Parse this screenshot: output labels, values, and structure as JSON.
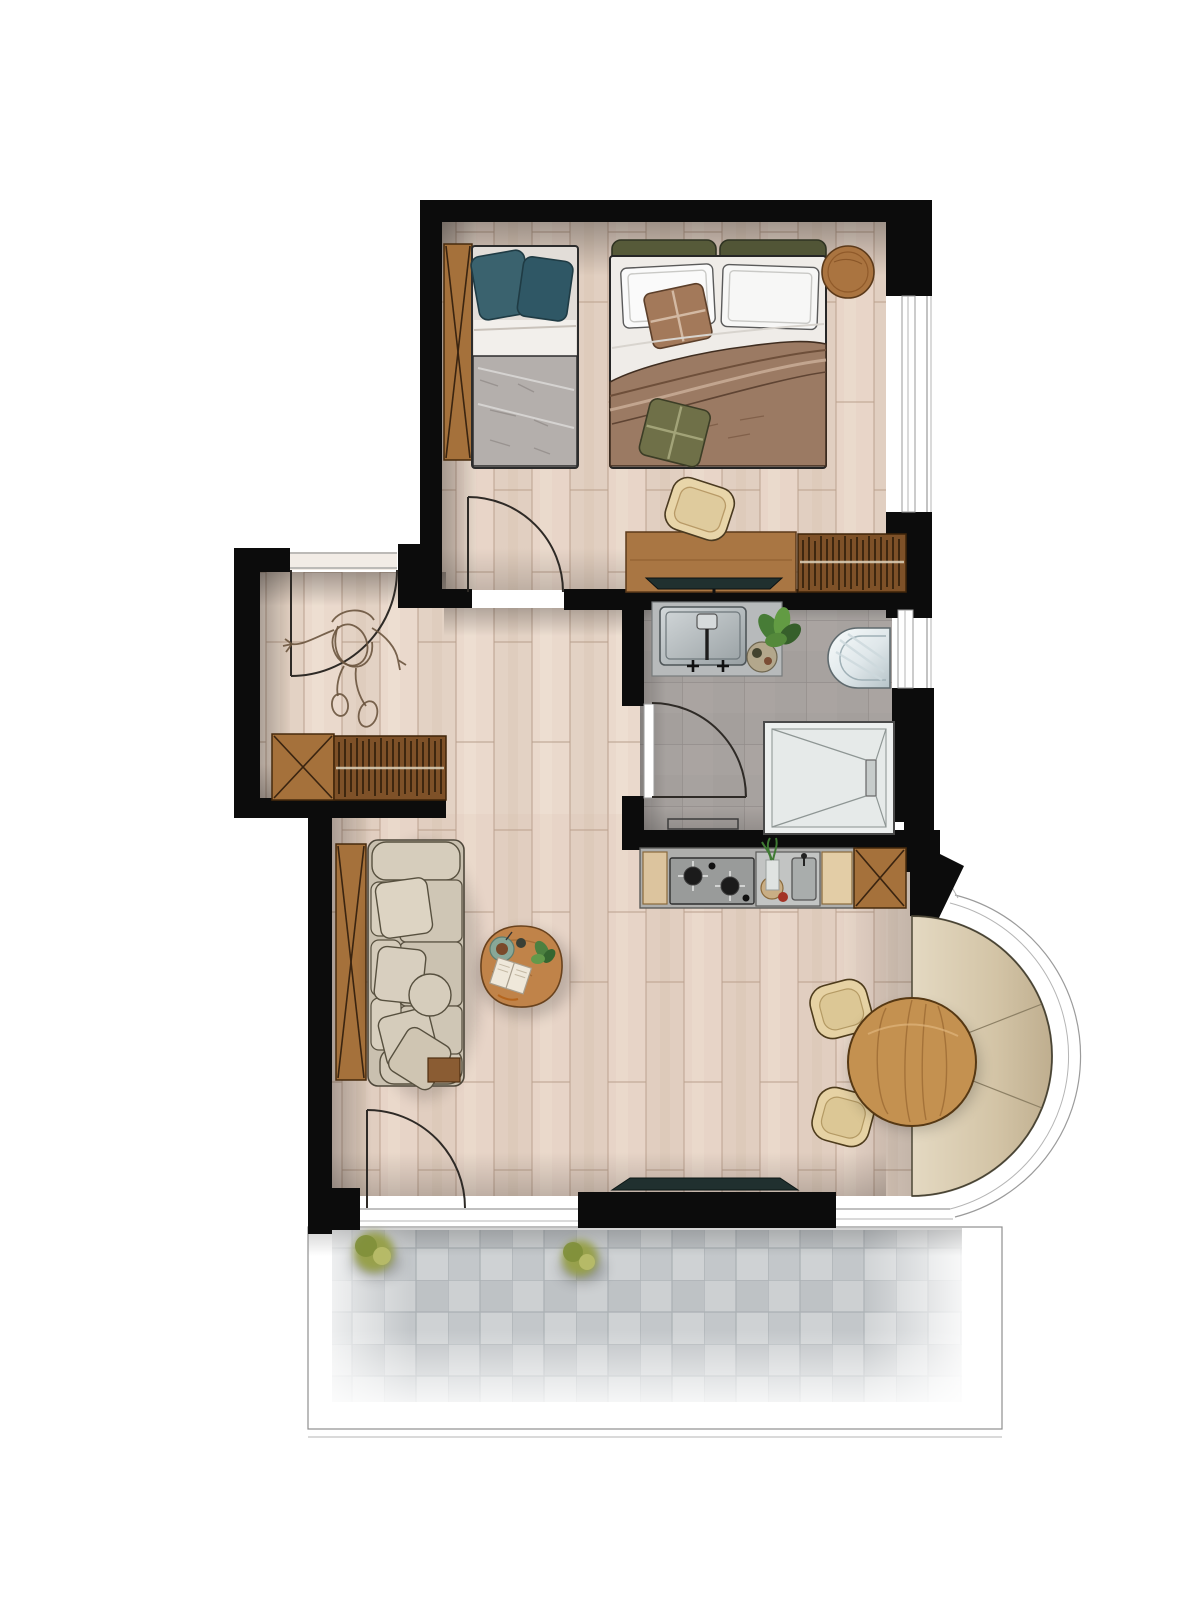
{
  "document": {
    "type": "architectural floor plan",
    "view": "top-down furnished apartment rendering",
    "visible_text": "none"
  },
  "palette": {
    "wall": "#0c0c0c",
    "wood-floor": "#ead9cc",
    "plank-line": "#b79e8b",
    "tile-floor": "#a7a29f",
    "cabinet-wood": "#a5713b",
    "slat-wood": "#7e5128",
    "desk-wood": "#a97643",
    "table-wood": "#c49150",
    "coffee-wood": "#c08349",
    "upholstery": "#c9c0af",
    "cream": "#e6d2a4",
    "banquette-light": "#e4d9c2",
    "banquette-dark": "#bfae8f",
    "teal-pillow": "#3a626e",
    "olive-pillow": "#6f7048",
    "headboard-olive": "#565a39",
    "blanket-brown": "#9b7a63",
    "accent-pillow-brown": "#a3795a",
    "steel": "#b7babb",
    "shower-white": "#edf0ef",
    "paver-gray": "#c6c9cb",
    "shrub-green": "#97a04b",
    "tv-dark": "#20302f"
  },
  "rooms": [
    {
      "id": "bedroom",
      "furniture": [
        "single-bed",
        "double-bed",
        "headboard-panel",
        "round-stool",
        "desk",
        "desk-chair",
        "bedroom-tv",
        "slatted-wardrobe"
      ]
    },
    {
      "id": "entry-hall",
      "furniture": [
        "sideboard",
        "person-sketch",
        "entrance-door"
      ]
    },
    {
      "id": "bathroom",
      "furniture": [
        "vanity-sink",
        "bath-plant",
        "toilet",
        "walk-in-shower",
        "bath-mat"
      ]
    },
    {
      "id": "kitchenette",
      "furniture": [
        "cooktop",
        "kitchen-sink",
        "x-cabinet"
      ]
    },
    {
      "id": "living-room",
      "furniture": [
        "sofa",
        "coffee-table",
        "lounge-tv",
        "wood-panel"
      ]
    },
    {
      "id": "bay-window",
      "furniture": [
        "curved-banquette",
        "round-dining-table",
        "dining-chair",
        "dining-chair"
      ]
    },
    {
      "id": "terrace",
      "furniture": [
        "stone-pavers",
        "shrub",
        "shrub"
      ]
    }
  ]
}
